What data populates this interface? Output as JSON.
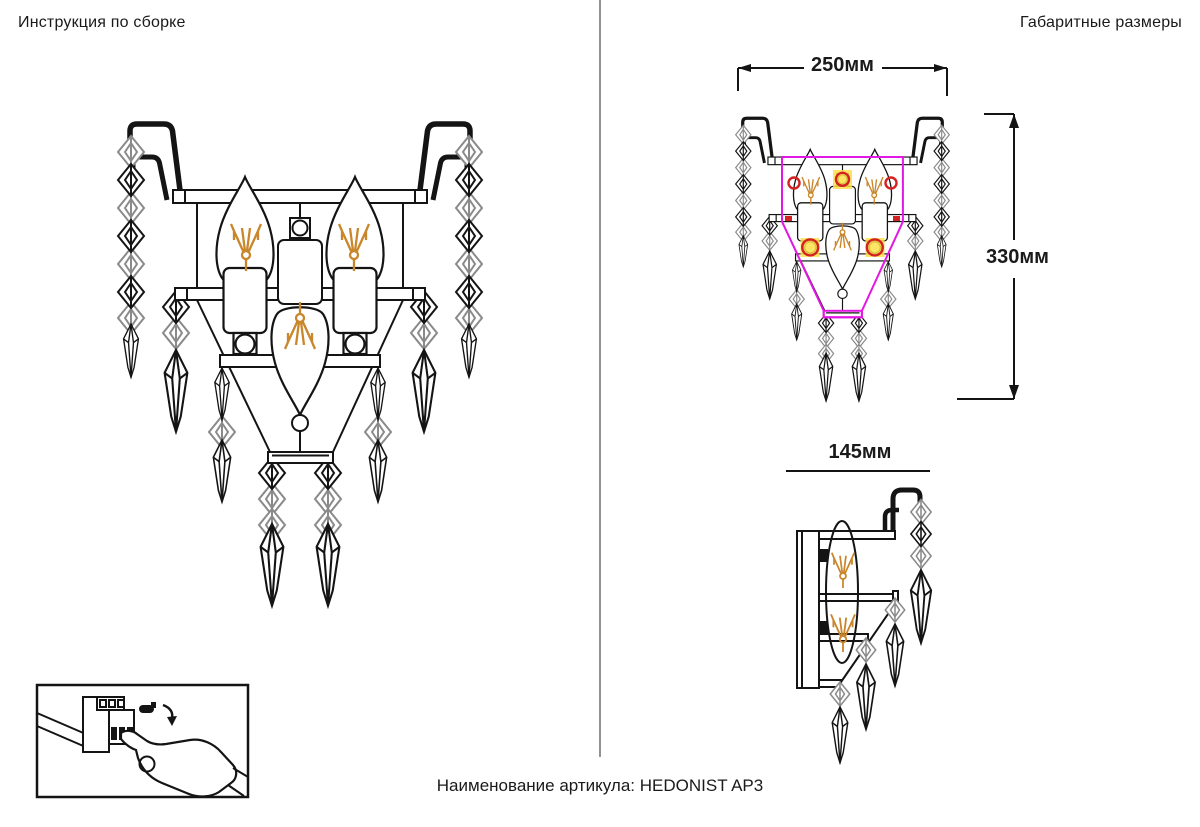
{
  "titles": {
    "assembly": "Инструкция по сборке",
    "dimensions": "Габаритные размеры"
  },
  "dimensions": {
    "width_label": "250мм",
    "height_label": "330мм",
    "depth_label": "145мм"
  },
  "footer": {
    "article_label": "Наименование артикула:",
    "article_value": "HEDONIST AP3"
  },
  "colors": {
    "line": "#141414",
    "crystal_gray": "#8a8a8a",
    "filament_orange": "#c9862b",
    "outline_magenta": "#e418e4",
    "marker_red": "#d42222",
    "marker_yellow": "#ffe14a"
  }
}
